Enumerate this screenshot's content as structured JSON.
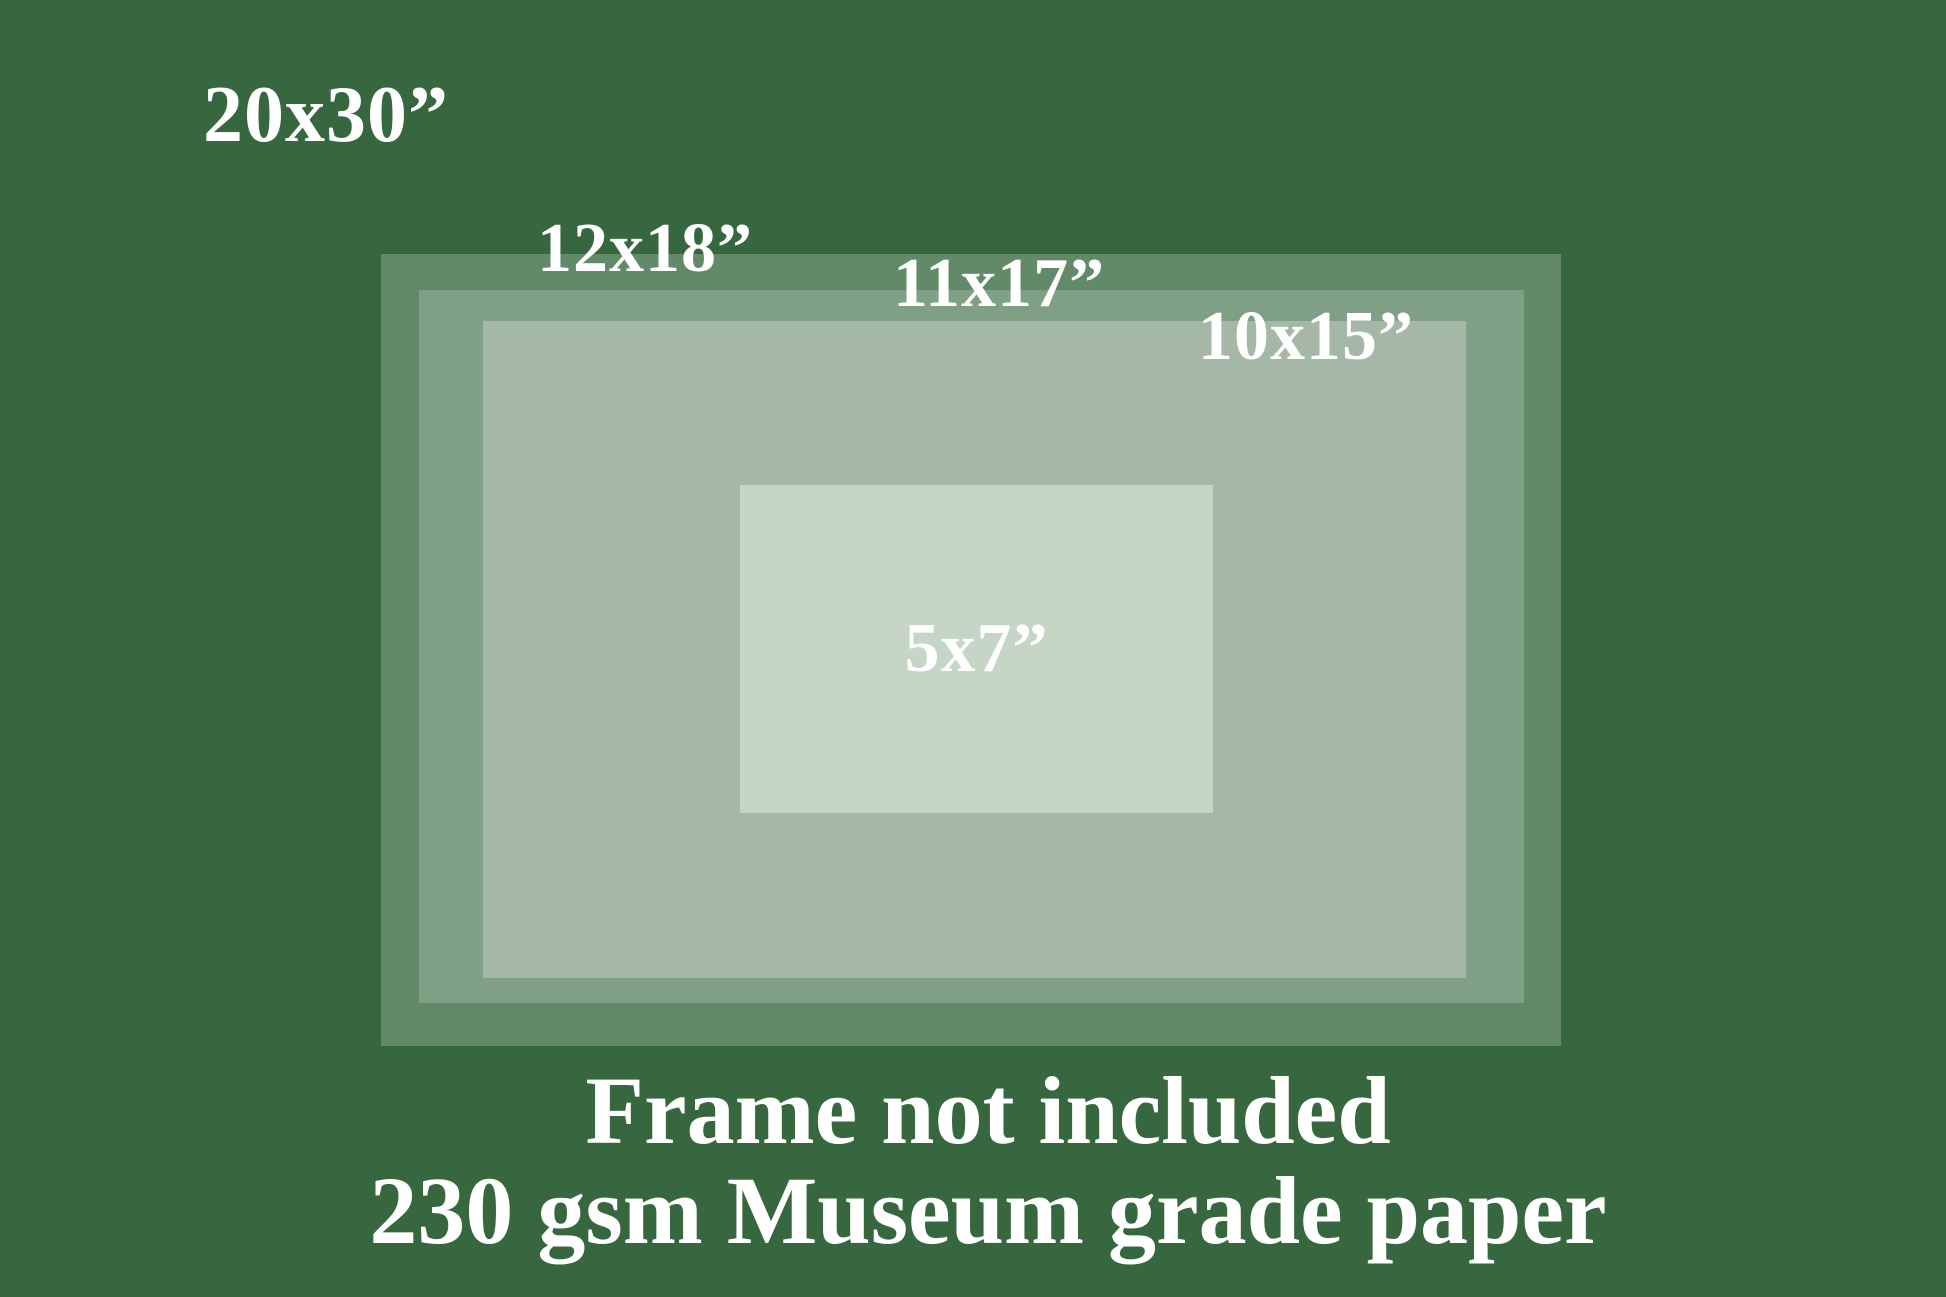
{
  "colors": {
    "background": "#36673F",
    "size_12x18": "#628A68",
    "size_11x17": "#7FA084",
    "size_10x15": "#A5B8A7",
    "size_5x7": "#C5D6C6",
    "text": "#FFFFFF"
  },
  "sizes": [
    {
      "id": "20x30",
      "label": "20x30”"
    },
    {
      "id": "12x18",
      "label": "12x18”"
    },
    {
      "id": "11x17",
      "label": "11x17”"
    },
    {
      "id": "10x15",
      "label": "10x15”"
    },
    {
      "id": "5x7",
      "label": "5x7”"
    }
  ],
  "footer": {
    "line1": "Frame not included",
    "line2": "230 gsm Museum grade paper"
  }
}
